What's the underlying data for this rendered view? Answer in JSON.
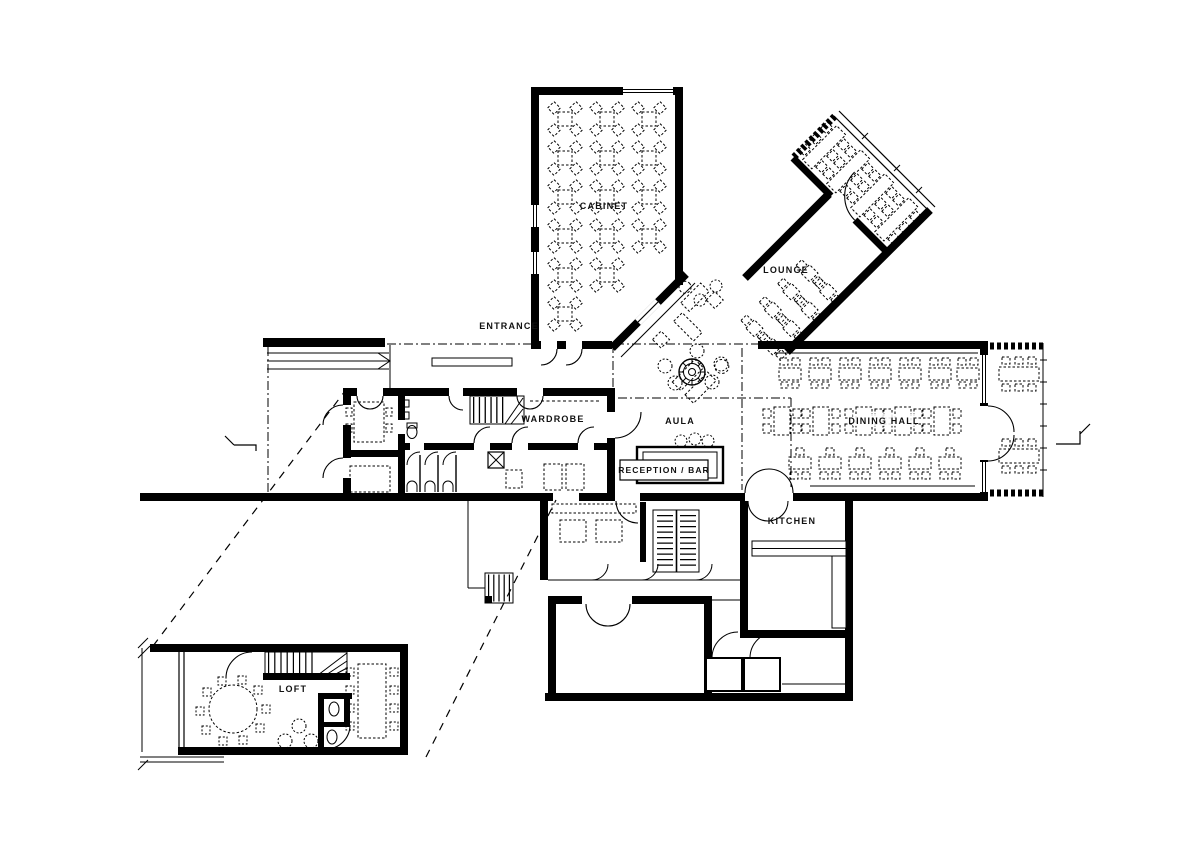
{
  "canvas": {
    "width": 1200,
    "height": 848,
    "background": "#ffffff",
    "ink": "#000000"
  },
  "plan": {
    "type": "architectural floor plan",
    "rooms": [
      {
        "id": "cabinet",
        "label": "CABINET"
      },
      {
        "id": "lounge",
        "label": "LOUNGE"
      },
      {
        "id": "entrance",
        "label": "ENTRANCE"
      },
      {
        "id": "wardrobe",
        "label": "WARDROBE"
      },
      {
        "id": "aula",
        "label": "AULA"
      },
      {
        "id": "reception_bar",
        "label": "RECEPTION / BAR"
      },
      {
        "id": "dining_hall",
        "label": "DINING HALL"
      },
      {
        "id": "kitchen",
        "label": "KITCHEN"
      },
      {
        "id": "loft",
        "label": "LOFT"
      }
    ]
  },
  "labels": {
    "cabinet": "CABINET",
    "lounge": "LOUNGE",
    "entrance": "ENTRANCE",
    "wardrobe": "WARDROBE",
    "aula": "AULA",
    "reception_bar": "RECEPTION / BAR",
    "dining_hall": "DINING HALL",
    "kitchen": "KITCHEN",
    "loft": "LOFT"
  }
}
